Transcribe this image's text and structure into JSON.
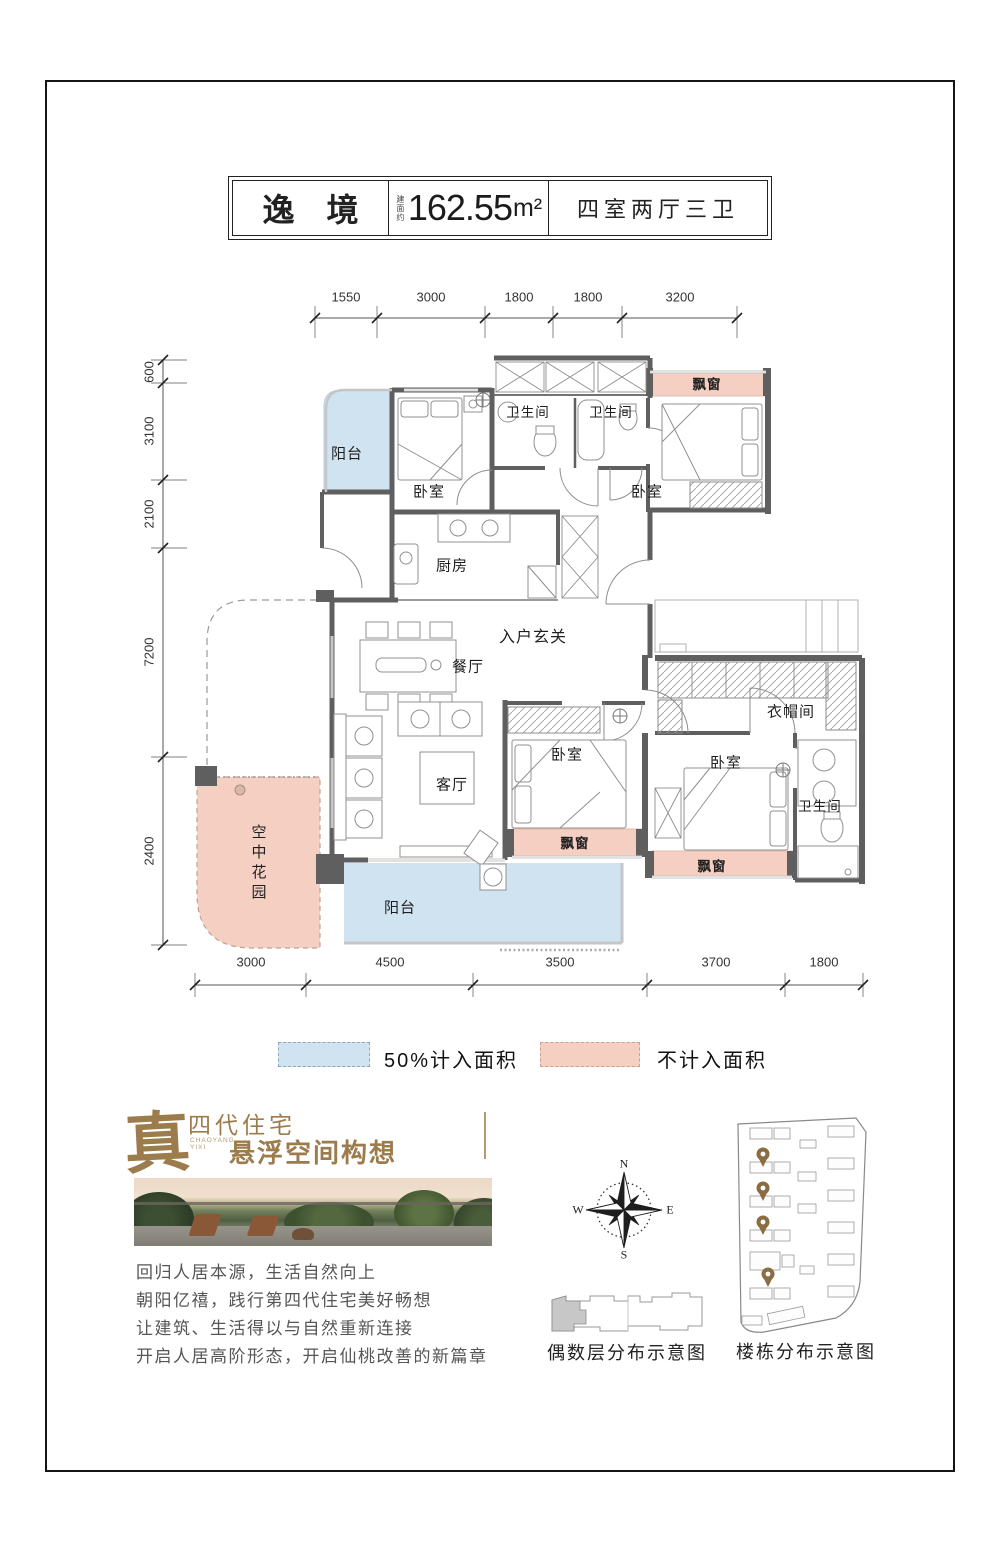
{
  "header": {
    "title": "逸　境",
    "area_label": "建面约",
    "area_value": "162.55",
    "area_unit": "m²",
    "spec": "四室两厅三卫"
  },
  "plan": {
    "dims_top": [
      "1550",
      "3000",
      "1800",
      "1800",
      "3200"
    ],
    "dims_left": [
      "600",
      "3100",
      "2100",
      "7200",
      "2400"
    ],
    "dims_bottom": [
      "3000",
      "4500",
      "3500",
      "3700",
      "1800"
    ],
    "rooms": {
      "balcony_top": "阳台",
      "bedroom_1": "卧室",
      "bath_1": "卫生间",
      "bath_2": "卫生间",
      "bay_top": "飘窗",
      "bedroom_2": "卧室",
      "kitchen": "厨房",
      "foyer": "入户玄关",
      "dining": "餐厅",
      "living": "客厅",
      "bedroom_3": "卧室",
      "bay_3": "飘窗",
      "cloakroom": "衣帽间",
      "bedroom_4": "卧室",
      "bath_3": "卫生间",
      "bay_4": "飘窗",
      "sky_garden": "空中花园",
      "balcony_bottom": "阳台"
    }
  },
  "legend": {
    "half_area": "50%计入面积",
    "excluded": "不计入面积"
  },
  "brand": {
    "seal": "真",
    "line1": "四代住宅",
    "en1": "CHAOYANG",
    "en2": "YIXI",
    "line2": "悬浮空间构想"
  },
  "intro": {
    "lines": [
      "回归人居本源，生活自然向上",
      "朝阳亿禧，践行第四代住宅美好畅想",
      "让建筑、生活得以与自然重新连接",
      "开启人居高阶形态，开启仙桃改善的新篇章"
    ]
  },
  "compass": {
    "n": "N",
    "e": "E",
    "s": "S",
    "w": "W"
  },
  "diagrams": {
    "floor_caption": "偶数层分布示意图",
    "site_caption": "楼栋分布示意图"
  },
  "colors": {
    "blue": "#cfe3f1",
    "pink": "#f5cfc2",
    "gold": "#9c7c4c",
    "wall": "#5f5f5f"
  }
}
